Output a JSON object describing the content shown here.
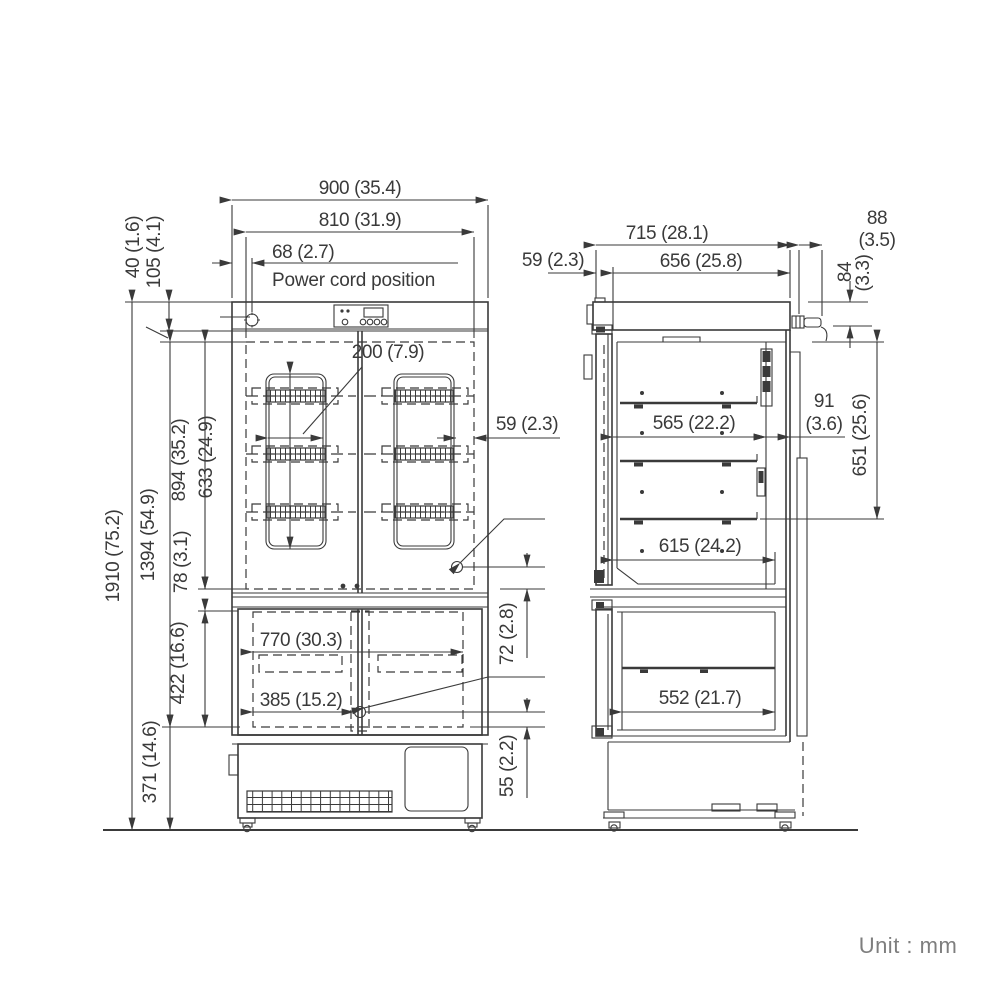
{
  "unit_label": "Unit : mm",
  "front_view": {
    "power_cord_note": "Power cord position",
    "dims": {
      "width_overall": "900 (35.4)",
      "width_interior": "810 (31.9)",
      "power_cord_offset": "68 (2.7)",
      "top_cap_height": "40 (1.6)",
      "panel_height": "105 (4.1)",
      "height_overall": "1910 (75.2)",
      "height_body": "1394 (54.9)",
      "upper_interior_height": "894 (35.2)",
      "rack_height": "633 (24.9)",
      "divider_height": "78 (3.1)",
      "lower_interior_height": "422 (16.6)",
      "base_height": "371 (14.6)",
      "rack_width": "200 (7.9)",
      "rack_side_gap": "59 (2.3)",
      "freezer_interior_width": "770 (30.3)",
      "freezer_door_width": "385 (15.2)",
      "upper_lock_offset": "72 (2.8)",
      "lower_lock_offset": "55 (2.2)"
    }
  },
  "side_view": {
    "dims": {
      "depth_overall": "715 (28.1)",
      "depth_body": "656 (25.8)",
      "door_thickness": "59 (2.3)",
      "cord_protrusion_mm": "88",
      "cord_protrusion_in": "(3.5)",
      "cord_drop_mm": "84",
      "cord_drop_in": "(3.3)",
      "shelf_depth": "565 (22.2)",
      "rear_duct_mm": "91",
      "rear_duct_in": "(3.6)",
      "upper_interior_height": "651 (25.6)",
      "lower_shelf_depth": "615 (24.2)",
      "freezer_interior_depth": "552 (21.7)"
    }
  }
}
